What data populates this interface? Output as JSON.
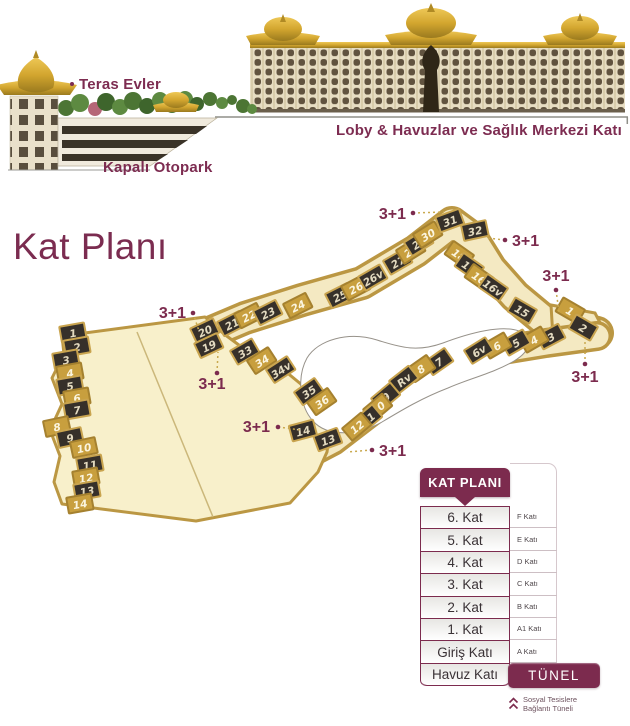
{
  "hero": {
    "teras_evler_label": "Teras Evler",
    "kapali_otopark_label": "Kapalı Otopark",
    "loby_label": "Loby & Havuzlar ve Sağlık Merkezi Katı"
  },
  "page_title": "Kat Planı",
  "plan": {
    "unit_type_label": "3+1",
    "units": [
      {
        "label": "1",
        "x": 73,
        "y": 333,
        "r": -10,
        "tone": "d"
      },
      {
        "label": "2",
        "x": 77,
        "y": 347,
        "r": -10,
        "tone": "d"
      },
      {
        "label": "3",
        "x": 66,
        "y": 360,
        "r": -10,
        "tone": "d"
      },
      {
        "label": "4",
        "x": 70,
        "y": 373,
        "r": -10,
        "tone": "l"
      },
      {
        "label": "5",
        "x": 70,
        "y": 386,
        "r": -10,
        "tone": "d"
      },
      {
        "label": "6",
        "x": 77,
        "y": 398,
        "r": -10,
        "tone": "l"
      },
      {
        "label": "7",
        "x": 77,
        "y": 410,
        "r": -10,
        "tone": "d"
      },
      {
        "label": "8",
        "x": 57,
        "y": 427,
        "r": -12,
        "tone": "l"
      },
      {
        "label": "9",
        "x": 70,
        "y": 438,
        "r": -12,
        "tone": "d"
      },
      {
        "label": "10",
        "x": 84,
        "y": 448,
        "r": -12,
        "tone": "l"
      },
      {
        "label": "11",
        "x": 90,
        "y": 465,
        "r": -10,
        "tone": "d"
      },
      {
        "label": "12",
        "x": 86,
        "y": 478,
        "r": -10,
        "tone": "l"
      },
      {
        "label": "13",
        "x": 87,
        "y": 491,
        "r": -10,
        "tone": "d"
      },
      {
        "label": "14",
        "x": 80,
        "y": 504,
        "r": -10,
        "tone": "l"
      },
      {
        "label": "20",
        "x": 205,
        "y": 331,
        "r": -25,
        "tone": "d"
      },
      {
        "label": "19",
        "x": 209,
        "y": 346,
        "r": -25,
        "tone": "d"
      },
      {
        "label": "21",
        "x": 232,
        "y": 324,
        "r": -27,
        "tone": "d"
      },
      {
        "label": "22",
        "x": 249,
        "y": 316,
        "r": -27,
        "tone": "l"
      },
      {
        "label": "23",
        "x": 268,
        "y": 313,
        "r": -27,
        "tone": "d"
      },
      {
        "label": "24",
        "x": 298,
        "y": 306,
        "r": -27,
        "tone": "l"
      },
      {
        "label": "25",
        "x": 340,
        "y": 296,
        "r": -27,
        "tone": "d"
      },
      {
        "label": "26",
        "x": 356,
        "y": 288,
        "r": -28,
        "tone": "l"
      },
      {
        "label": "26v",
        "x": 373,
        "y": 278,
        "r": -30,
        "tone": "d"
      },
      {
        "label": "27",
        "x": 398,
        "y": 262,
        "r": -30,
        "tone": "d"
      },
      {
        "label": "28",
        "x": 411,
        "y": 251,
        "r": -32,
        "tone": "l"
      },
      {
        "label": "29",
        "x": 419,
        "y": 243,
        "r": -32,
        "tone": "d"
      },
      {
        "label": "30",
        "x": 428,
        "y": 235,
        "r": -32,
        "tone": "l"
      },
      {
        "label": "31",
        "x": 450,
        "y": 221,
        "r": -20,
        "tone": "d"
      },
      {
        "label": "32",
        "x": 475,
        "y": 231,
        "r": -12,
        "tone": "d"
      },
      {
        "label": "18",
        "x": 459,
        "y": 255,
        "r": 35,
        "tone": "l"
      },
      {
        "label": "17",
        "x": 469,
        "y": 267,
        "r": 35,
        "tone": "d"
      },
      {
        "label": "16",
        "x": 479,
        "y": 278,
        "r": 35,
        "tone": "l"
      },
      {
        "label": "16v",
        "x": 493,
        "y": 288,
        "r": 35,
        "tone": "d"
      },
      {
        "label": "15",
        "x": 522,
        "y": 311,
        "r": 30,
        "tone": "d"
      },
      {
        "label": "1",
        "x": 570,
        "y": 311,
        "r": 30,
        "tone": "l"
      },
      {
        "label": "2",
        "x": 583,
        "y": 328,
        "r": 30,
        "tone": "d"
      },
      {
        "label": "3",
        "x": 551,
        "y": 337,
        "r": -28,
        "tone": "d"
      },
      {
        "label": "4",
        "x": 534,
        "y": 340,
        "r": -30,
        "tone": "l"
      },
      {
        "label": "5",
        "x": 516,
        "y": 343,
        "r": -30,
        "tone": "d"
      },
      {
        "label": "6",
        "x": 497,
        "y": 346,
        "r": -30,
        "tone": "l"
      },
      {
        "label": "6v",
        "x": 479,
        "y": 351,
        "r": -32,
        "tone": "d"
      },
      {
        "label": "7",
        "x": 439,
        "y": 362,
        "r": -35,
        "tone": "d"
      },
      {
        "label": "8",
        "x": 421,
        "y": 369,
        "r": -35,
        "tone": "l"
      },
      {
        "label": "Rv",
        "x": 404,
        "y": 380,
        "r": -38,
        "tone": "d"
      },
      {
        "label": "9",
        "x": 386,
        "y": 397,
        "r": -40,
        "tone": "d"
      },
      {
        "label": "10",
        "x": 378,
        "y": 408,
        "r": -40,
        "tone": "l"
      },
      {
        "label": "11",
        "x": 368,
        "y": 419,
        "r": -40,
        "tone": "d"
      },
      {
        "label": "12",
        "x": 357,
        "y": 427,
        "r": -40,
        "tone": "l"
      },
      {
        "label": "13",
        "x": 328,
        "y": 440,
        "r": -20,
        "tone": "d"
      },
      {
        "label": "14",
        "x": 303,
        "y": 431,
        "r": -15,
        "tone": "d"
      },
      {
        "label": "33",
        "x": 245,
        "y": 352,
        "r": -30,
        "tone": "d"
      },
      {
        "label": "34",
        "x": 262,
        "y": 361,
        "r": -33,
        "tone": "l"
      },
      {
        "label": "34v",
        "x": 281,
        "y": 370,
        "r": -33,
        "tone": "d"
      },
      {
        "label": "35",
        "x": 309,
        "y": 392,
        "r": -35,
        "tone": "d"
      },
      {
        "label": "36",
        "x": 322,
        "y": 402,
        "r": -35,
        "tone": "l"
      }
    ],
    "callouts": [
      {
        "label": "3+1",
        "tx": 406,
        "ty": 219,
        "anchor": "end",
        "dx": 413,
        "dy": 213,
        "lx": 444,
        "ly": 212
      },
      {
        "label": "3+1",
        "tx": 512,
        "ty": 246,
        "anchor": "start",
        "dx": 505,
        "dy": 240,
        "lx": 487,
        "ly": 238
      },
      {
        "label": "3+1",
        "tx": 556,
        "ty": 281,
        "anchor": "middle",
        "dx": 556,
        "dy": 290,
        "lx": 559,
        "ly": 312
      },
      {
        "label": "3+1",
        "tx": 585,
        "ty": 382,
        "anchor": "middle",
        "dx": 585,
        "dy": 364,
        "lx": 585,
        "ly": 340
      },
      {
        "label": "3+1",
        "tx": 186,
        "ty": 318,
        "anchor": "end",
        "dx": 193,
        "dy": 313,
        "lx": 199,
        "ly": 331
      },
      {
        "label": "3+1",
        "tx": 212,
        "ty": 389,
        "anchor": "middle",
        "dx": 217,
        "dy": 373,
        "lx": 218,
        "ly": 352
      },
      {
        "label": "3+1",
        "tx": 270,
        "ty": 432,
        "anchor": "end",
        "dx": 278,
        "dy": 427,
        "lx": 301,
        "ly": 430
      },
      {
        "label": "3+1",
        "tx": 379,
        "ty": 456,
        "anchor": "start",
        "dx": 372,
        "dy": 450,
        "lx": 347,
        "ly": 452
      }
    ]
  },
  "floor_table": {
    "header": "KAT PLANI",
    "rows": [
      {
        "name": "6. Kat",
        "code": "F Katı"
      },
      {
        "name": "5. Kat",
        "code": "E Katı"
      },
      {
        "name": "4. Kat",
        "code": "D Katı"
      },
      {
        "name": "3. Kat",
        "code": "C Katı"
      },
      {
        "name": "2. Kat",
        "code": "B Katı"
      },
      {
        "name": "1. Kat",
        "code": "A1 Katı"
      },
      {
        "name": "Giriş Katı",
        "code": "A Katı"
      },
      {
        "name": "Havuz Katı",
        "code": ""
      }
    ],
    "tunnel_button": "TÜNEL",
    "tunnel_note_line1": "Sosyal Tesislere",
    "tunnel_note_line2": "Bağlantı Tüneli"
  },
  "colors": {
    "accent_plum": "#7c2b4e",
    "gold": "#bb9743",
    "plan_beige": "#f4e9c2",
    "chip_dark": "#36302a"
  }
}
